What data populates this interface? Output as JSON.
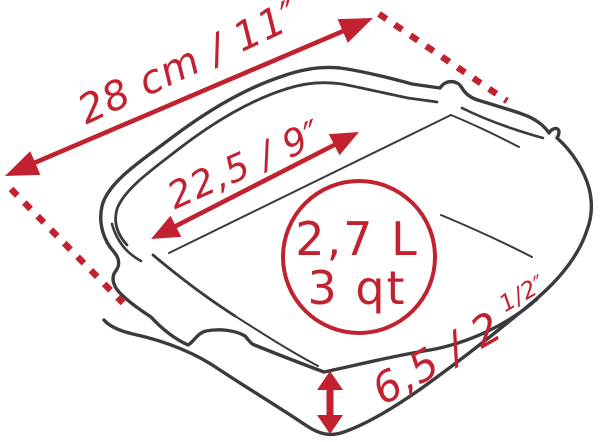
{
  "diagram": {
    "type": "product-dimension-diagram",
    "subject": "square baking dish line drawing",
    "colors": {
      "accent_red": "#c22130",
      "line_dark": "#3b3b3d",
      "background": "#ffffff"
    },
    "measurements": {
      "outer_width": {
        "label": "28 cm / 11″",
        "meaning": "outer diagonal width"
      },
      "inner_width": {
        "label": "22,5 / 9″",
        "meaning": "inner width"
      },
      "capacity": {
        "liters": "2,7 L",
        "quarts": "3 qt"
      },
      "height": {
        "label": "6,5 / 2",
        "fraction": "1/2″",
        "meaning": "wall height"
      }
    }
  }
}
